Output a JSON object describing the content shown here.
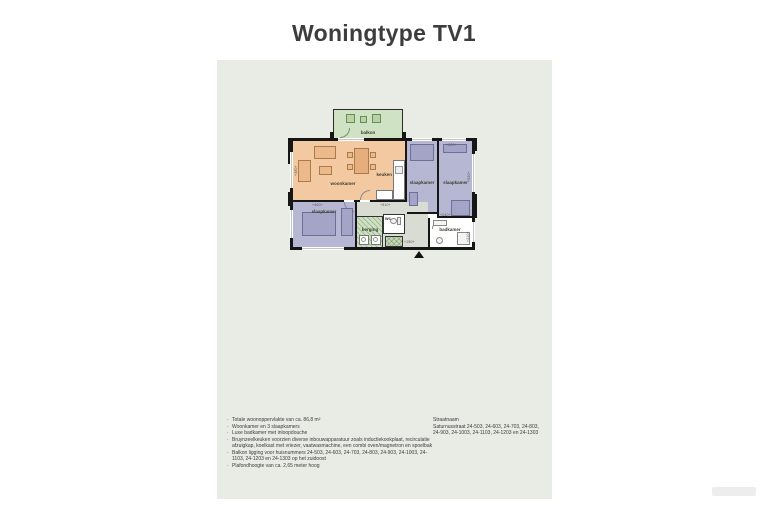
{
  "title": "Woningtype TV1",
  "floorplan": {
    "labels": {
      "balkon": "balkon",
      "woonkamer": "woonkamer",
      "keuken": "keuken",
      "slaapkamer": "slaapkamer",
      "berging": "berging",
      "wc": "wc",
      "badkamer": "badkamer"
    },
    "dims": {
      "bedroom_b_top": "+220+",
      "bedroom_c_top": "+400+",
      "hall_top": "+510+",
      "badkamer_top": "+240+",
      "badkamer_right": "+210+",
      "entrance": "+150+",
      "woonkamer_left": "+380+",
      "bedroom_b_right": "+520+"
    },
    "colors": {
      "panel": "#e9ebe5",
      "balcony": "#cfe2c3",
      "living": "#f3c9a1",
      "bedroom": "#b6b7d3",
      "hall": "#d9dcd2",
      "storage": "#cde0c2",
      "walls": "#161616"
    }
  },
  "notes": {
    "items": [
      "Totale woonoppervlakte van ca. 86,8 m²",
      "Woonkamer en 3 slaapkamers",
      "Luxe badkamer met inloopdouche",
      "Bruynzeelkeuken voorzien diverse inbouwapparatuur zoals inductiekookplaat, recirculatie afzuigkap, koelkast met vriezer, vaatwasmachine, een combi oven/magnetron en spoelbak",
      "Balkon ligging voor huisnummers 24-503, 24-603, 24-703, 24-803, 24-903, 24-1003, 24-1103, 24-1203 en 24-1303 op het zuidoost",
      "Plafondhoogte van ca. 2,65 meter hoog"
    ]
  },
  "address": {
    "heading": "Straatnaam",
    "line1": "Saturnusstraat 24-503, 24-603, 24-703, 24-803,",
    "line2": "24-903, 24-1003, 24-1103, 24-1203 en 24-1303"
  }
}
